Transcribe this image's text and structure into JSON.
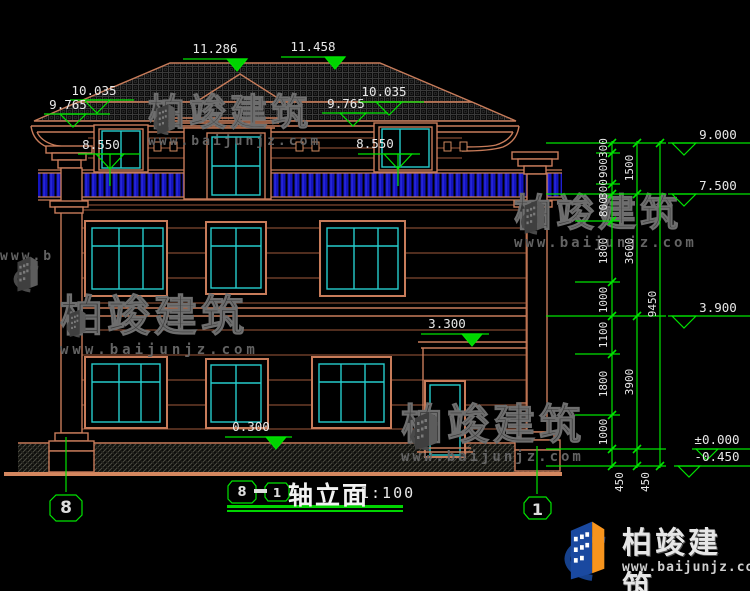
{
  "watermark": {
    "name": "柏竣建筑",
    "url": "www.baijunjz.com"
  },
  "footer": {
    "brand": "柏竣建筑",
    "url": "www.baijunjz.com"
  },
  "title": {
    "axis_start": "8",
    "axis_end": "1",
    "dash": "—",
    "name": "轴立面",
    "scale": "1:100"
  },
  "axes": {
    "left_bubble": "8",
    "right_bubble": "1"
  },
  "markers": {
    "m11286": "11.286",
    "m11458": "11.458",
    "l10035": "10.035",
    "l9765": "9.765",
    "l8550": "8.550",
    "r9765": "9.765",
    "r10035": "10.035",
    "r8550": "8.550",
    "m3300": "3.300",
    "m0300": "0.300",
    "r9000": "9.000",
    "r7500": "7.500",
    "r3900": "3.900",
    "r0000": "±0.000",
    "rm0450": "-0.450"
  },
  "dims": {
    "inner": [
      "300",
      "900",
      "300",
      "800",
      "1800",
      "1000",
      "1100",
      "1800",
      "1000"
    ],
    "middle": [
      "1500",
      "3600",
      "3900"
    ],
    "overall": "9450",
    "below": [
      "450",
      "450"
    ]
  }
}
